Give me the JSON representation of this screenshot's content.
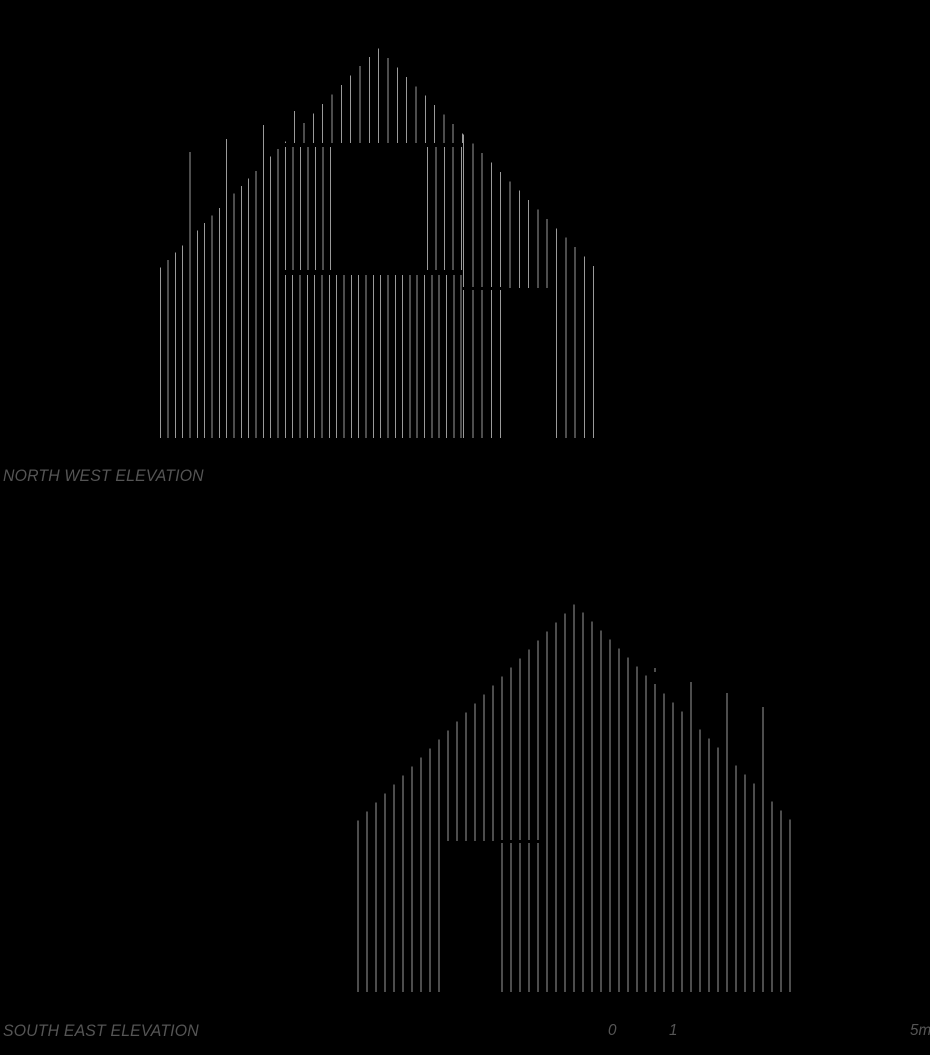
{
  "page": {
    "width": 930,
    "height": 1055,
    "background": "#000000"
  },
  "text_color": "#555555",
  "drawing": {
    "line_color": "#9a9a9a",
    "line_width": 1,
    "elevations": [
      {
        "id": "north-west",
        "label": "NORTH WEST ELEVATION",
        "label_pos": {
          "x": 3,
          "y": 466
        },
        "apex": {
          "x": 378,
          "y": 48
        },
        "roof_slope": 1.01,
        "base_y": 438,
        "line_groups": [
          {
            "x0": 160.7,
            "spacing": 7.33,
            "count": 17,
            "top": "profile",
            "bottom": 438,
            "tall_overrides": [
              {
                "index": 4,
                "top": 152
              },
              {
                "index": 9,
                "top": 139
              },
              {
                "index": 14,
                "top": 125
              }
            ]
          },
          {
            "x0": 285.3,
            "spacing": 9.33,
            "count": 20,
            "top": "profile",
            "bottom": 143,
            "tall_overrides": [
              {
                "index": 1,
                "top": 111
              }
            ]
          },
          {
            "x0": 285.5,
            "spacing": 7.5,
            "count": 7,
            "top": 147,
            "bottom": 270,
            "tall_overrides": []
          },
          {
            "x0": 427.7,
            "spacing": 8.5,
            "count": 5,
            "top": 147,
            "bottom": 270,
            "tall_overrides": []
          },
          {
            "x0": 285.3,
            "spacing": 7.33,
            "count": 25,
            "top": 275,
            "bottom": 438,
            "tall_overrides": []
          },
          {
            "x0": 463.5,
            "spacing": 9.3,
            "count": 15,
            "top": "profile",
            "bottom": 438,
            "tall_overrides": []
          }
        ],
        "cuts": [
          {
            "x1": 502,
            "x2": 552,
            "y1": 288,
            "y2": 438,
            "kind": "door-opening"
          },
          {
            "x1": 462,
            "x2": 502,
            "y1": 287,
            "y2": 290,
            "kind": "panel-seam"
          }
        ],
        "openings_note": {
          "window": "x 331-427, y 143-270 (blank)",
          "door": "x 502-552, y 288-438 (blank)"
        }
      },
      {
        "id": "south-east",
        "label": "SOUTH EAST ELEVATION",
        "label_pos": {
          "x": 3,
          "y": 1021
        },
        "apex": {
          "x": 574.7,
          "y": 604
        },
        "roof_slope": 1.0,
        "base_y": 992,
        "line_groups": [
          {
            "x0": 358,
            "spacing": 9.0,
            "count": 49,
            "top": "profile",
            "bottom": 992,
            "tall_overrides": [
              {
                "index": 33,
                "top": 668
              },
              {
                "index": 37,
                "top": 682
              },
              {
                "index": 41,
                "top": 693
              },
              {
                "index": 45,
                "top": 707
              }
            ]
          }
        ],
        "cuts": [
          {
            "x1": 444,
            "x2": 497,
            "y1": 841,
            "y2": 992,
            "kind": "door-opening"
          },
          {
            "x1": 497,
            "x2": 541,
            "y1": 840,
            "y2": 843,
            "kind": "door-head-seam"
          },
          {
            "x1": 653,
            "x2": 658,
            "y1": 672,
            "y2": 684,
            "kind": "batten-gap"
          }
        ],
        "openings_note": {
          "door": "x 444-497, y 841-992 (blank), door leaf battens x 502-538"
        }
      }
    ],
    "scale_bar": {
      "labels": [
        {
          "text": "0",
          "x": 608,
          "y": 1022
        },
        {
          "text": "1",
          "x": 669,
          "y": 1022
        },
        {
          "text": "5m",
          "x": 910,
          "y": 1022
        }
      ],
      "pixels_per_metre": 60
    }
  }
}
